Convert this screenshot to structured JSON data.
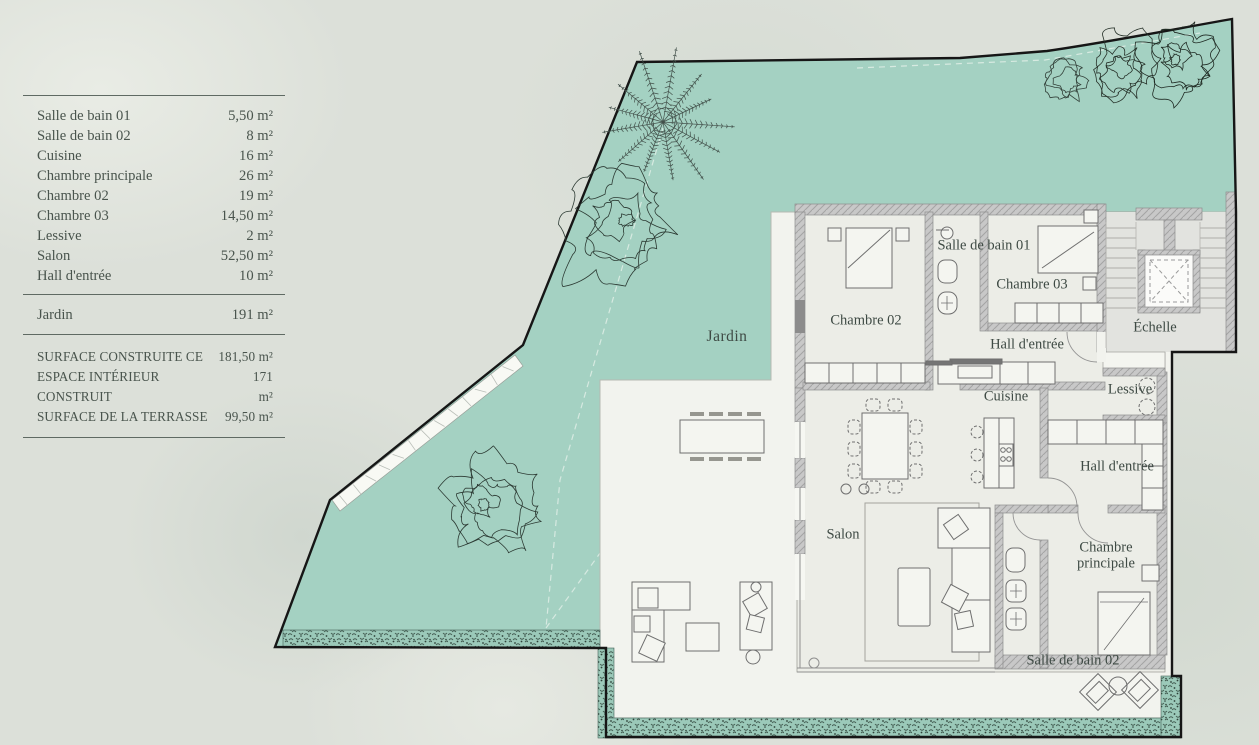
{
  "legend": {
    "rooms": [
      {
        "label": "Salle de bain 01",
        "area": "5,50 m²"
      },
      {
        "label": "Salle de bain 02",
        "area": "8 m²"
      },
      {
        "label": "Cuisine",
        "area": "16 m²"
      },
      {
        "label": "Chambre principale",
        "area": "26 m²"
      },
      {
        "label": "Chambre 02",
        "area": "19 m²"
      },
      {
        "label": "Chambre 03",
        "area": "14,50 m²"
      },
      {
        "label": "Lessive",
        "area": "2 m²"
      },
      {
        "label": "Salon",
        "area": "52,50 m²"
      },
      {
        "label": "Hall d'entrée",
        "area": "10 m²"
      }
    ],
    "garden": {
      "label": "Jardin",
      "area": "191 m²"
    },
    "summary": [
      {
        "label": "SURFACE CONSTRUITE CE",
        "area": "181,50 m²"
      },
      {
        "label": "ESPACE INTÉRIEUR CONSTRUIT",
        "area": "171 m²"
      },
      {
        "label": "SURFACE DE LA TERRASSE",
        "area": "99,50 m²"
      }
    ]
  },
  "plan": {
    "labels": {
      "jardin": "Jardin",
      "chambre02": "Chambre 02",
      "sdb01": "Salle de bain 01",
      "chambre03": "Chambre 03",
      "echelle": "Échelle",
      "hall_upper": "Hall d'entrée",
      "lessive": "Lessive",
      "cuisine": "Cuisine",
      "hall_lower": "Hall d'entrée",
      "salon": "Salon",
      "chambre_principale_1": "Chambre",
      "chambre_principale_2": "principale",
      "sdb02": "Salle de bain 02"
    }
  },
  "colors": {
    "garden": "#a4d1c2",
    "terrace": "#f2f3ee",
    "floor": "#ecede7",
    "stair_floor": "#e2e3df",
    "wall": "#c8c8c8",
    "boundary": "#161616",
    "text": "#3e4a44",
    "background": "#dce0d9",
    "hedge_dark": "#425b50"
  }
}
